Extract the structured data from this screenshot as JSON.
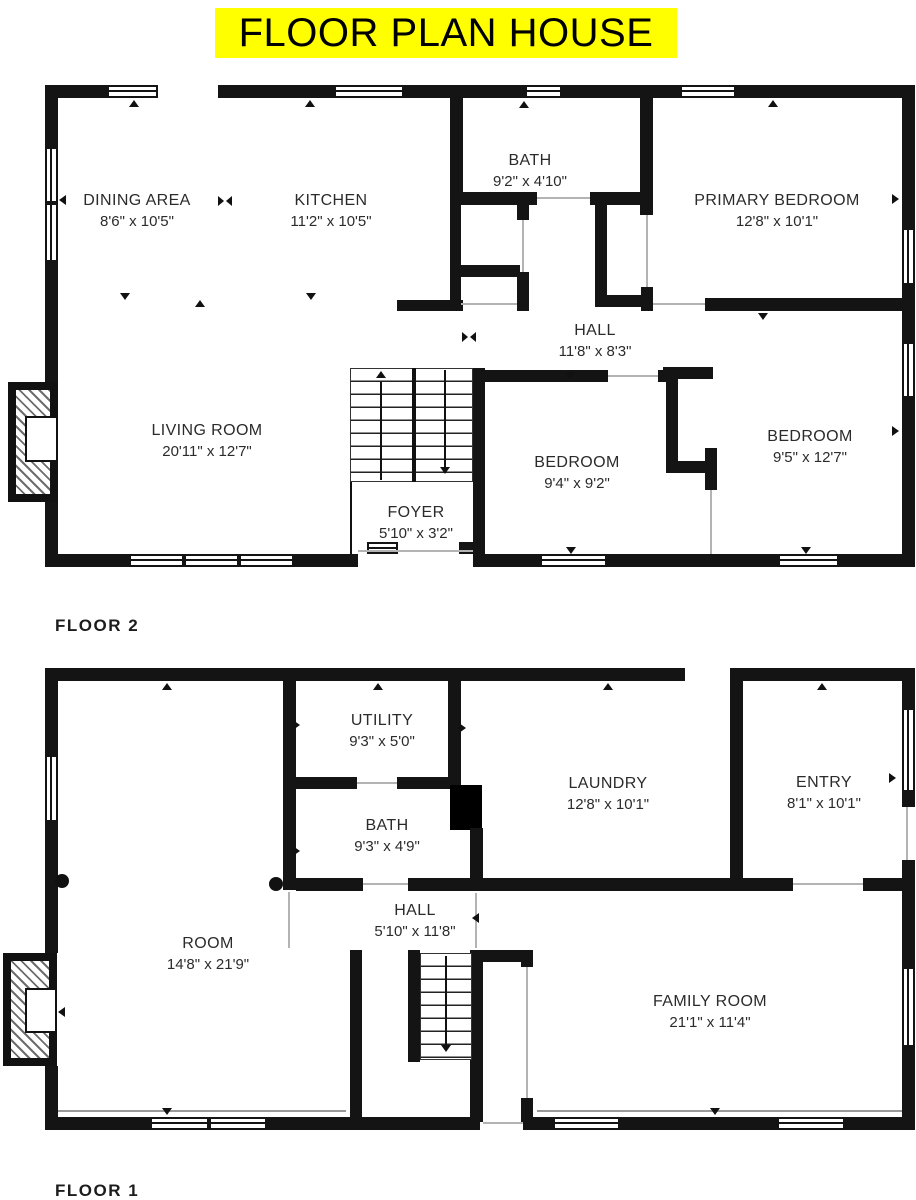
{
  "title": "FLOOR PLAN HOUSE",
  "colors": {
    "highlight": "#FFFF00",
    "wall": "#141414",
    "text": "#2b2b2b"
  },
  "floors": [
    {
      "label": "FLOOR 2",
      "rooms": [
        {
          "name": "DINING AREA",
          "dims": "8'6\" x 10'5\""
        },
        {
          "name": "KITCHEN",
          "dims": "11'2\" x 10'5\""
        },
        {
          "name": "BATH",
          "dims": "9'2\" x 4'10\""
        },
        {
          "name": "PRIMARY BEDROOM",
          "dims": "12'8\" x 10'1\""
        },
        {
          "name": "HALL",
          "dims": "11'8\" x 8'3\""
        },
        {
          "name": "LIVING ROOM",
          "dims": "20'11\" x 12'7\""
        },
        {
          "name": "BEDROOM",
          "dims": "9'4\" x 9'2\""
        },
        {
          "name": "BEDROOM",
          "dims": "9'5\" x 12'7\""
        },
        {
          "name": "FOYER",
          "dims": "5'10\" x 3'2\""
        }
      ]
    },
    {
      "label": "FLOOR 1",
      "rooms": [
        {
          "name": "UTILITY",
          "dims": "9'3\" x 5'0\""
        },
        {
          "name": "BATH",
          "dims": "9'3\" x 4'9\""
        },
        {
          "name": "LAUNDRY",
          "dims": "12'8\" x 10'1\""
        },
        {
          "name": "ENTRY",
          "dims": "8'1\" x 10'1\""
        },
        {
          "name": "HALL",
          "dims": "5'10\" x 11'8\""
        },
        {
          "name": "ROOM",
          "dims": "14'8\" x 21'9\""
        },
        {
          "name": "FAMILY ROOM",
          "dims": "21'1\" x 11'4\""
        }
      ]
    }
  ]
}
